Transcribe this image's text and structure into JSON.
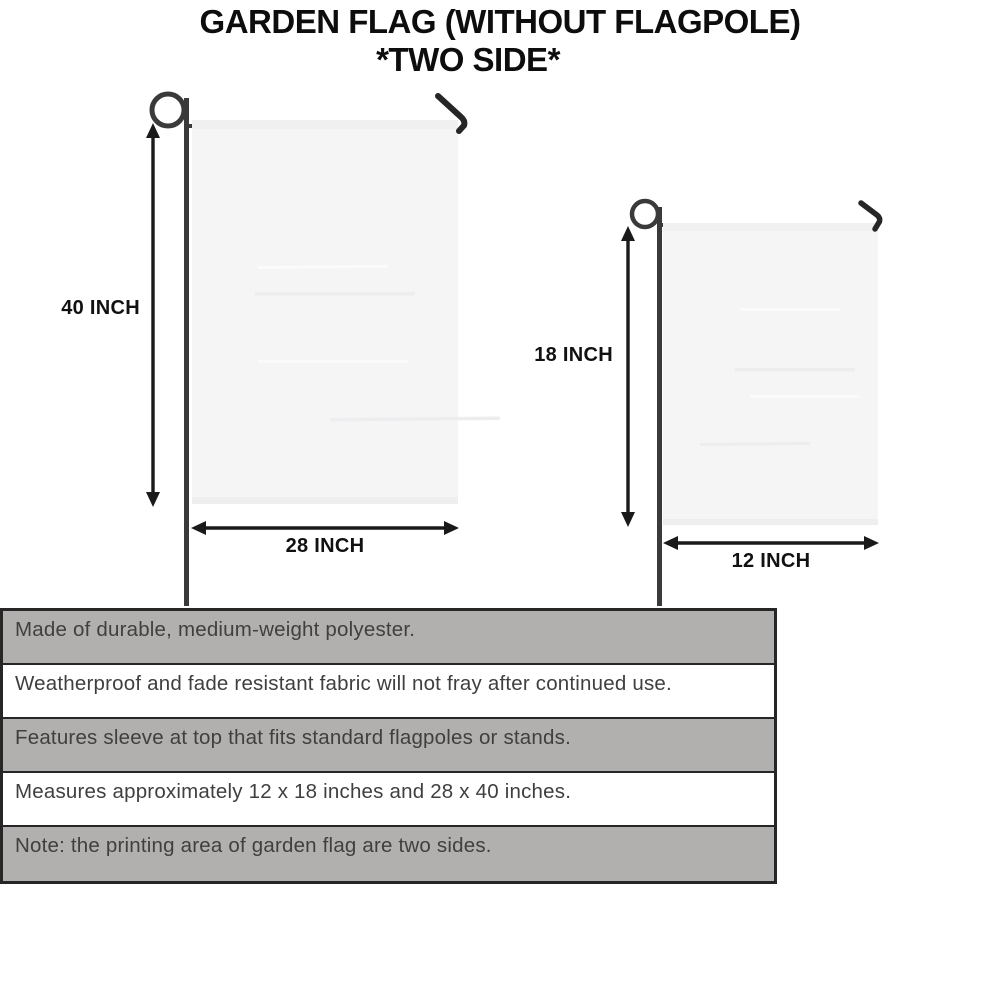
{
  "title": {
    "line1": "GARDEN FLAG (WITHOUT FLAGPOLE)",
    "line2": "*TWO SIDE*"
  },
  "diagram": {
    "large_flag": {
      "name": "28 x 40 inch garden flag on stand",
      "height_label": "40 INCH",
      "width_label": "28 INCH"
    },
    "small_flag": {
      "name": "12 x 18 inch garden flag on stand",
      "height_label": "18 INCH",
      "width_label": "12 INCH"
    }
  },
  "spec_table": {
    "rows": [
      {
        "text": "Made of durable, medium-weight polyester.",
        "shade": "gray"
      },
      {
        "text": "Weatherproof and fade resistant fabric will not fray after continued use.",
        "shade": "white"
      },
      {
        "text": "Features sleeve at top that fits standard flagpoles or stands.",
        "shade": "gray"
      },
      {
        "text": "Measures approximately 12 x 18 inches and 28 x 40 inches.",
        "shade": "white"
      },
      {
        "text": "Note: the printing area of garden flag are two sides.",
        "shade": "gray"
      }
    ]
  },
  "colors": {
    "background": "#ffffff",
    "title_text": "#0d0d0d",
    "flag_fill": "#f5f5f6",
    "flag_sleeve": "#f0f0f1",
    "pole": "#3a3a3a",
    "hook": "#262626",
    "dimension_arrow": "#1a1a1a",
    "table_row_gray": "#b2b0af",
    "table_border": "#262626",
    "table_text": "#3f3f3f"
  }
}
